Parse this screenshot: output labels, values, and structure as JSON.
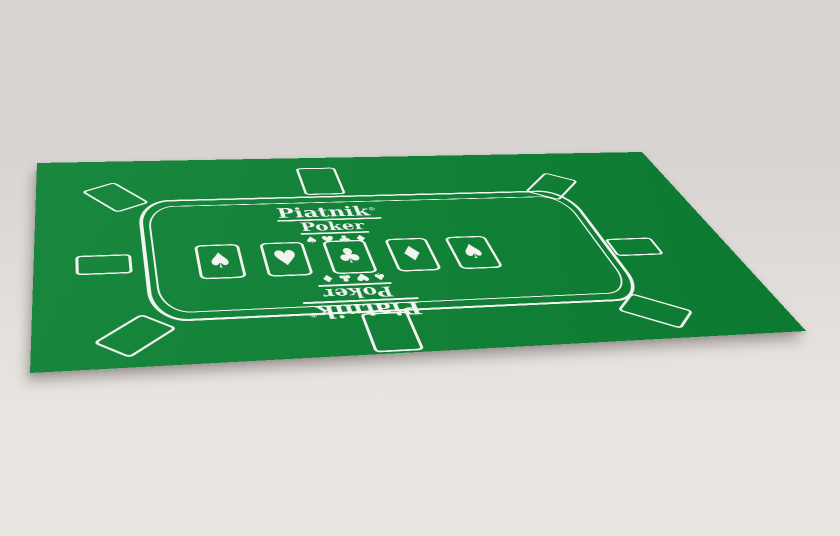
{
  "brand": {
    "name": "Piatnik",
    "mark": "®",
    "product": "Poker",
    "suits": "♠♥♣♦"
  },
  "board_cards": [
    {
      "name": "spade",
      "suit": "♠"
    },
    {
      "name": "heart",
      "suit": "♥"
    },
    {
      "name": "club",
      "suit": "♣"
    },
    {
      "name": "diamond",
      "suit": "♦"
    },
    {
      "name": "spade",
      "suit": "♠"
    }
  ],
  "colors": {
    "felt": "#0D8134",
    "print": "#F2F4EF",
    "bg_top": "#D8D4D1",
    "bg_bottom": "#E9E6E2",
    "shadow": "rgba(104,98,92,0.40)",
    "shadow2": "rgba(104,98,92,0.35)"
  }
}
